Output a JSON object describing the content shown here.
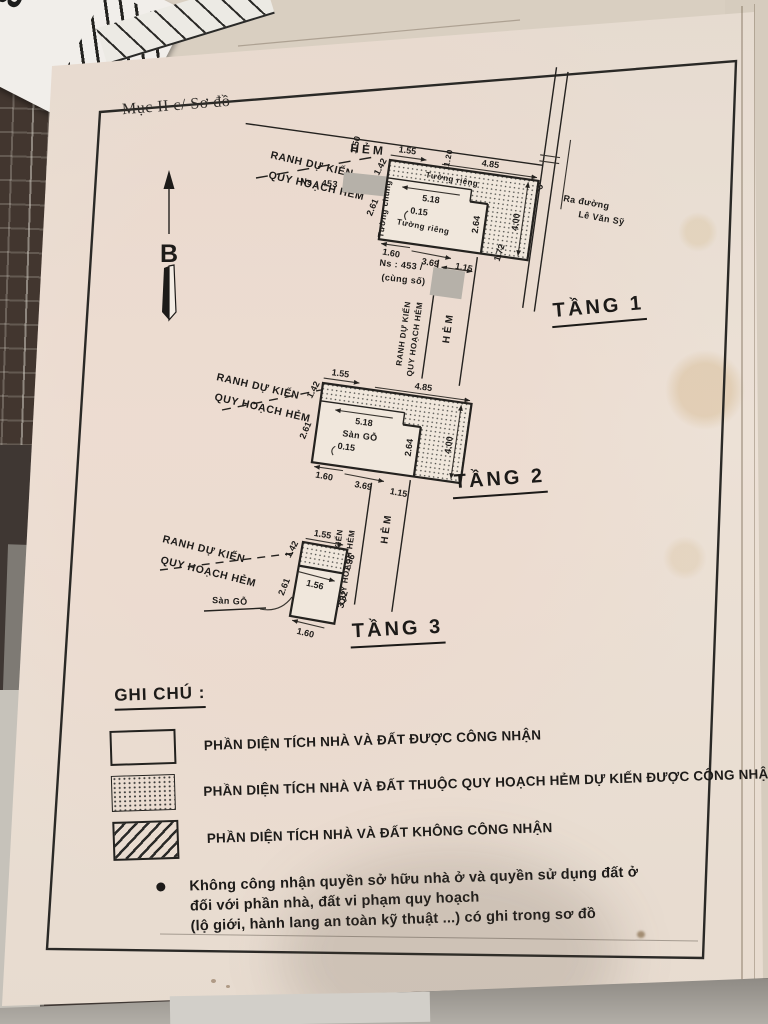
{
  "photo": {
    "card_number": "453"
  },
  "doc": {
    "header": "Mục II c/ Sơ đồ",
    "north": "B"
  },
  "floors": {
    "f1": "TẦNG 1",
    "f2": "TẦNG 2",
    "f3": "TẦNG 3"
  },
  "labels": {
    "ranh1": "RANH DỰ KIẾN",
    "ranh2": "QUY HOẠCH HẺM",
    "hem": "HẺM",
    "tuong_chung": "Tường chung",
    "tuong_rieng": "Tường riêng",
    "san_go": "Sàn GỖ",
    "ra_duong": "Ra đường",
    "street": "Lê Văn Sỹ",
    "ns": "Ns : 453",
    "ns2a": "Ns : 453 /",
    "ns2b": "(cùng số)"
  },
  "dims": {
    "d015": "0.15",
    "d115": "1.15",
    "d120": "1.20",
    "d136": "1.36",
    "d142": "1.42",
    "d145": "1.45",
    "d150": "1.50",
    "d155": "1.55",
    "d156": "1.56",
    "d160": "1.60",
    "d172": "1.72",
    "d200": "2.00",
    "d261": "2.61",
    "d264": "2.64",
    "d332": "3.32",
    "d369": "3.69",
    "d400": "4.00",
    "d485": "4.85",
    "d518": "5.18"
  },
  "legend": {
    "title": "GHI CHÚ :",
    "items": [
      {
        "label": "PHẦN DIỆN TÍCH NHÀ VÀ ĐẤT ĐƯỢC CÔNG NHẬN"
      },
      {
        "label": "PHẦN DIỆN TÍCH NHÀ VÀ ĐẤT THUỘC QUY HOẠCH HẺM DỰ KIẾN ĐƯỢC CÔNG NHẬN"
      },
      {
        "label": "PHẦN DIỆN TÍCH NHÀ VÀ ĐẤT KHÔNG CÔNG NHẬN"
      }
    ],
    "note": [
      "Không công nhận quyền sở hữu nhà ở và quyền sử dụng đất ở",
      "đối với phần nhà, đất vi phạm quy hoạch",
      "(lộ giới, hành lang an toàn kỹ thuật ...) có ghi trong sơ đồ"
    ]
  },
  "colors": {
    "paper": "#eadfd4",
    "ink": "#1d1b19",
    "redaction": "#b6b1a9"
  }
}
